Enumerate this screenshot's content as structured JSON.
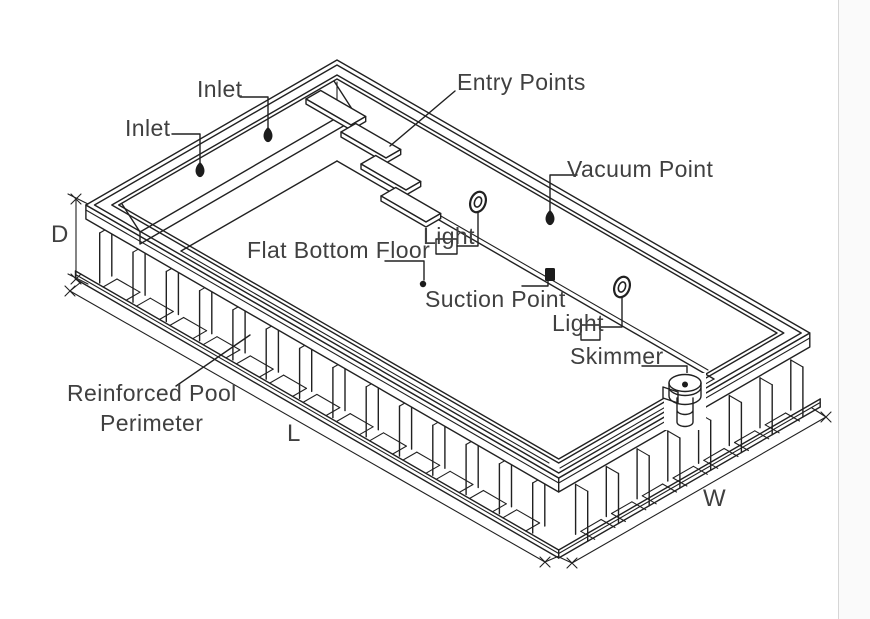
{
  "canvas": {
    "width": 870,
    "height": 619,
    "background": "#ffffff",
    "line_color": "#212121",
    "text_color": "#404040",
    "right_panel": {
      "background": "#fafafa",
      "border_color": "#d6d6d6"
    }
  },
  "diagram": {
    "type": "isometric pool technical drawing",
    "labels": {
      "inlet_top": "Inlet",
      "inlet_left": "Inlet",
      "entry_points": "Entry Points",
      "vacuum_point": "Vacuum Point",
      "flat_bottom_floor": "Flat Bottom Floor",
      "light_upper": "Light",
      "light_lower": "Light",
      "suction_point": "Suction Point",
      "skimmer": "Skimmer",
      "reinforced_pool_line1": "Reinforced Pool",
      "reinforced_pool_line2": "Perimeter",
      "dim_depth": "D",
      "dim_length": "L",
      "dim_width": "W"
    }
  }
}
